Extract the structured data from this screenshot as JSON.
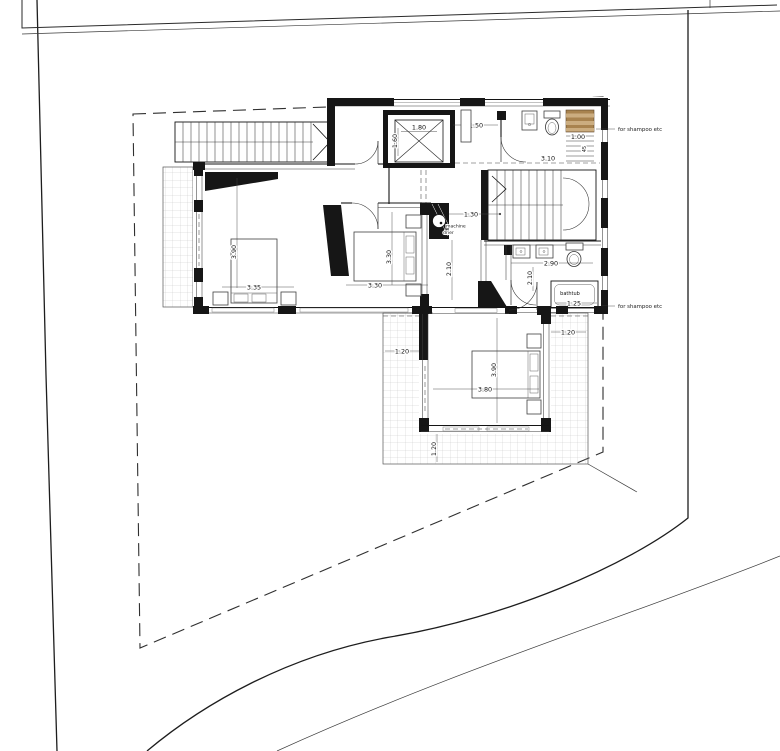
{
  "plan": {
    "title": "villa-upper-floor-plan",
    "labels": {
      "elevator_width": "1.80",
      "elevator_depth": "1.60",
      "hall_width": "1.50",
      "landing_width": "3.10",
      "shelf_width": "1.00",
      "shelf_depth": "45",
      "closet_width": "1.30",
      "corridor_width": "2.10",
      "bedroom1_length": "3.90",
      "bedroom1_width": "3.35",
      "bedroom2_length": "3.30",
      "bedroom2_width": "3.30",
      "bathroom_width": "2.90",
      "bathroom_depth": "2.10",
      "bathtub_label": "bathtub",
      "bathtub_width": "1.25",
      "bedroom3_length": "3.90",
      "bedroom3_width": "3.80",
      "terrace_left": "1.20",
      "terrace_right": "1.20",
      "terrace_bottom": "1.20",
      "note_shampoo_top": "for shampoo etc",
      "note_shampoo_bottom": "for shampoo etc",
      "machine_label": "machine",
      "drier_label": "drier"
    },
    "colors": {
      "shelf_wood_dark": "#a8834f",
      "shelf_wood_light": "#cbad80",
      "wall_fill": "#161616",
      "grid_line": "#b9b9b9"
    }
  }
}
